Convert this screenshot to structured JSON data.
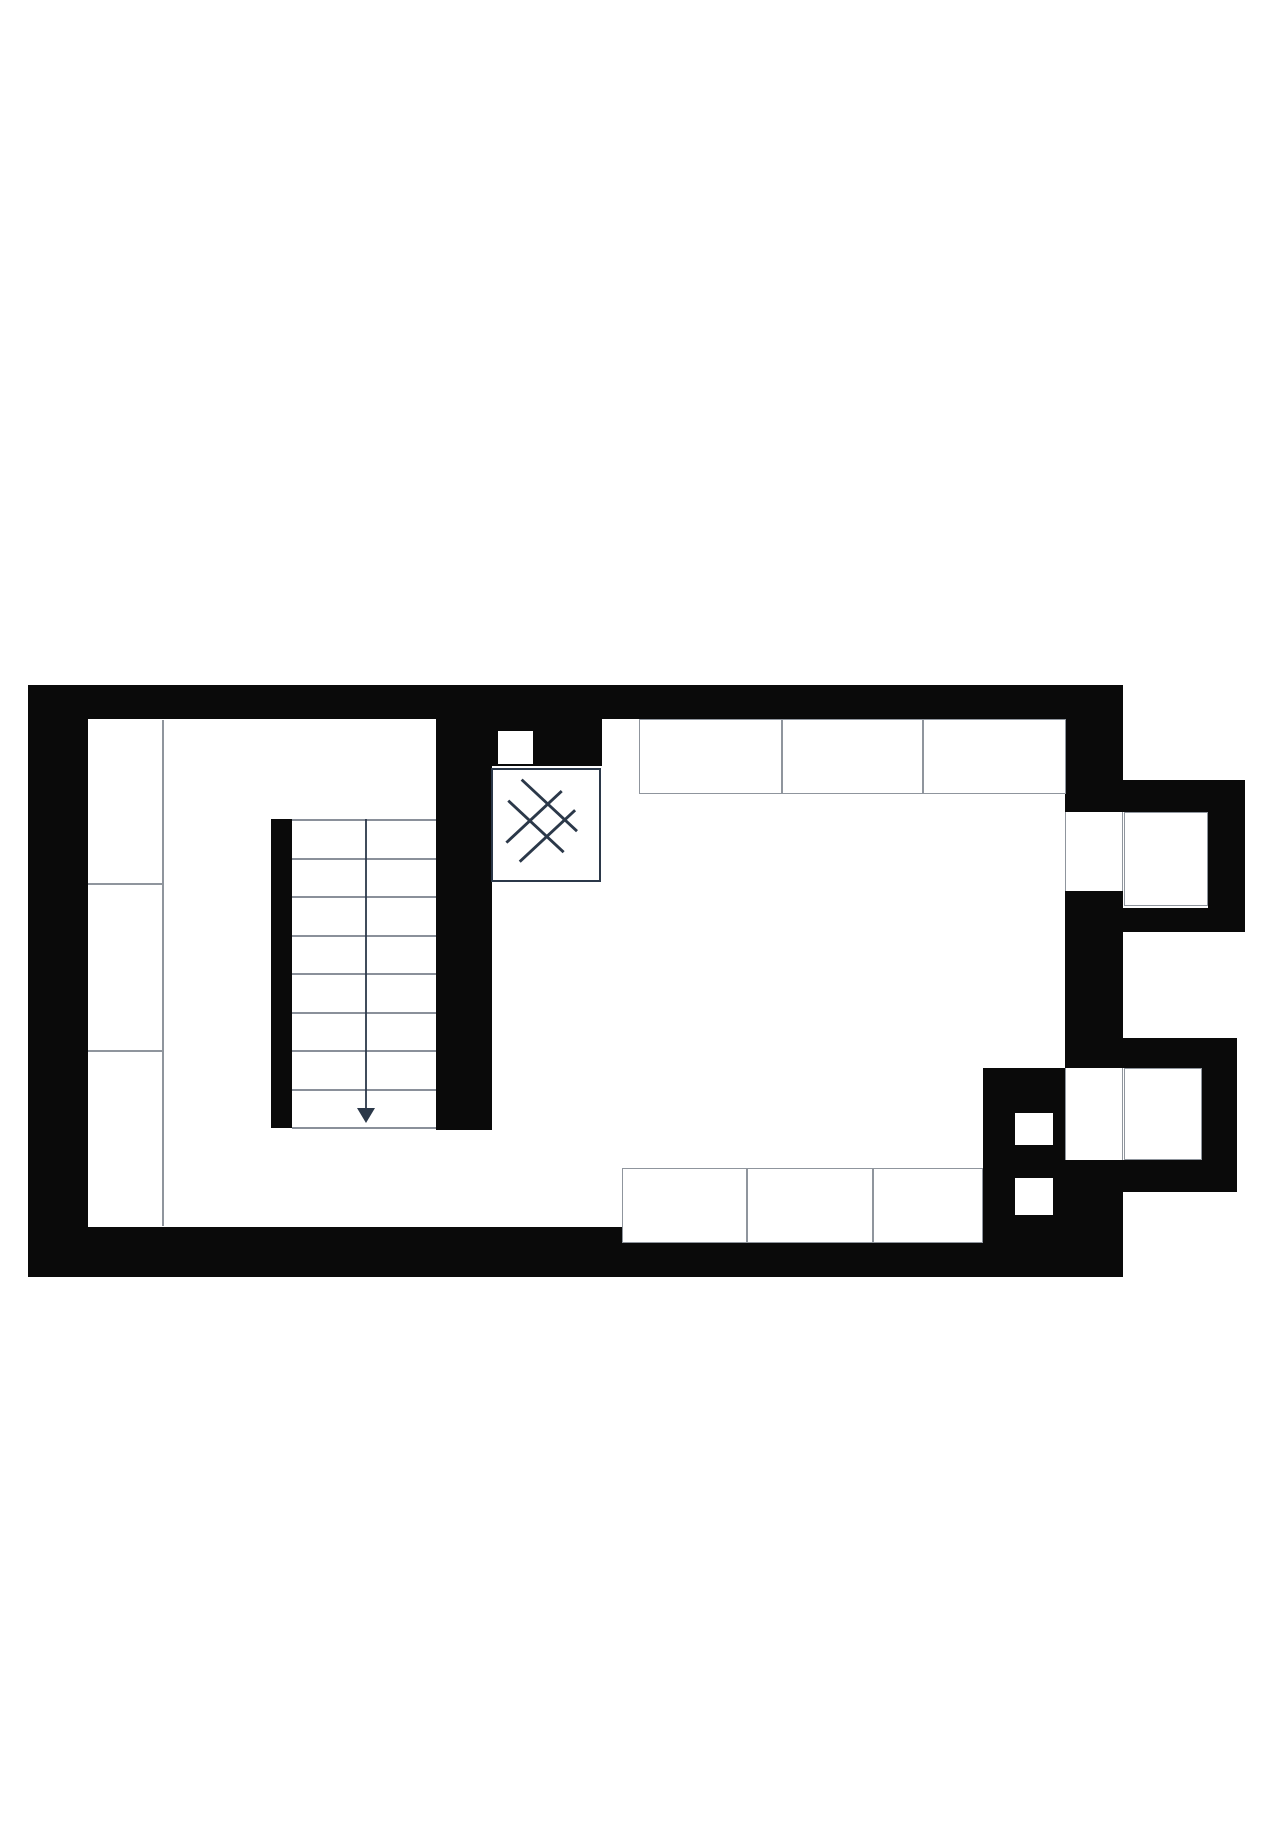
{
  "colors": {
    "background": "#ffffff",
    "wall": "#0a0a0a",
    "outline_gray": "#8f959d",
    "outline_dark": "#2b3849",
    "tread_gray": "#8a909a"
  },
  "plan": {
    "canvas": {
      "w": 1280,
      "h": 1833
    },
    "walls": [
      {
        "name": "top-wall",
        "x": 28,
        "y": 685,
        "w": 1095,
        "h": 34
      },
      {
        "name": "left-wall",
        "x": 28,
        "y": 685,
        "w": 60,
        "h": 592
      },
      {
        "name": "bottom-wall",
        "x": 28,
        "y": 1227,
        "w": 1095,
        "h": 50
      },
      {
        "name": "right-wall",
        "x": 1065,
        "y": 719,
        "w": 58,
        "h": 558
      },
      {
        "name": "middle-wall",
        "x": 436,
        "y": 719,
        "w": 56,
        "h": 411
      },
      {
        "name": "shower-enclosure-wall",
        "x": 436,
        "y": 719,
        "w": 166,
        "h": 47
      },
      {
        "name": "stair-spine-wall",
        "x": 271,
        "y": 819,
        "w": 21,
        "h": 309
      },
      {
        "name": "chimney-block",
        "x": 983,
        "y": 1068,
        "w": 82,
        "h": 209
      },
      {
        "name": "upper-bay-wall-top",
        "x": 1123,
        "y": 780,
        "w": 122,
        "h": 32
      },
      {
        "name": "upper-bay-wall-right",
        "x": 1208,
        "y": 780,
        "w": 37,
        "h": 152
      },
      {
        "name": "upper-bay-wall-bottom",
        "x": 1123,
        "y": 908,
        "w": 122,
        "h": 24
      },
      {
        "name": "lower-bay-wall-top",
        "x": 1123,
        "y": 1038,
        "w": 114,
        "h": 30
      },
      {
        "name": "lower-bay-wall-right",
        "x": 1202,
        "y": 1038,
        "w": 35,
        "h": 154
      },
      {
        "name": "lower-bay-wall-bottom",
        "x": 1123,
        "y": 1160,
        "w": 114,
        "h": 32
      }
    ],
    "openings": [
      {
        "name": "upper-window-opening",
        "x": 1065,
        "y": 812,
        "w": 58,
        "h": 79,
        "style": "edged"
      },
      {
        "name": "upper-bay-interior",
        "x": 1124,
        "y": 812,
        "w": 84,
        "h": 94,
        "style": "outlined"
      },
      {
        "name": "lower-window-opening",
        "x": 1065,
        "y": 1068,
        "w": 58,
        "h": 92,
        "style": "edged"
      },
      {
        "name": "lower-bay-interior",
        "x": 1124,
        "y": 1068,
        "w": 78,
        "h": 92,
        "style": "outlined"
      },
      {
        "name": "duct-opening",
        "x": 498,
        "y": 731,
        "w": 35,
        "h": 33,
        "style": "plain"
      },
      {
        "name": "chimney-flue-upper",
        "x": 1015,
        "y": 1113,
        "w": 38,
        "h": 32,
        "style": "plain"
      },
      {
        "name": "chimney-flue-lower",
        "x": 1015,
        "y": 1178,
        "w": 38,
        "h": 37,
        "style": "plain"
      }
    ],
    "furniture": [
      {
        "name": "top-counter-cell-1",
        "x": 639,
        "y": 719,
        "w": 143,
        "h": 75
      },
      {
        "name": "top-counter-cell-2",
        "x": 782,
        "y": 719,
        "w": 141,
        "h": 75
      },
      {
        "name": "top-counter-cell-3",
        "x": 923,
        "y": 719,
        "w": 143,
        "h": 75
      },
      {
        "name": "bottom-counter-cell-1",
        "x": 622,
        "y": 1168,
        "w": 125,
        "h": 75
      },
      {
        "name": "bottom-counter-cell-2",
        "x": 747,
        "y": 1168,
        "w": 126,
        "h": 75
      },
      {
        "name": "bottom-counter-cell-3",
        "x": 873,
        "y": 1168,
        "w": 110,
        "h": 75
      }
    ],
    "lines": [
      {
        "name": "closet-front-line",
        "x": 162,
        "y": 720,
        "w": 2,
        "h": 506
      },
      {
        "name": "closet-divider-1",
        "x": 88,
        "y": 883,
        "w": 76,
        "h": 2
      },
      {
        "name": "closet-divider-2",
        "x": 88,
        "y": 1050,
        "w": 76,
        "h": 2
      }
    ],
    "shower": {
      "name": "shower-tray",
      "x": 491,
      "y": 768,
      "w": 110,
      "h": 114,
      "glyph_lines": [
        [
          14,
          76,
          72,
          22
        ],
        [
          28,
          96,
          86,
          42
        ],
        [
          30,
          10,
          88,
          64
        ],
        [
          16,
          32,
          74,
          86
        ]
      ]
    },
    "stairs": {
      "name": "staircase",
      "x": 292,
      "y": 819,
      "w": 144,
      "h": 309,
      "tread_count": 8,
      "center_x": 74,
      "arrow": {
        "line_top": 0,
        "line_bottom": 290,
        "head_base": 289,
        "head_tip": 304,
        "head_half_width": 9
      }
    }
  }
}
